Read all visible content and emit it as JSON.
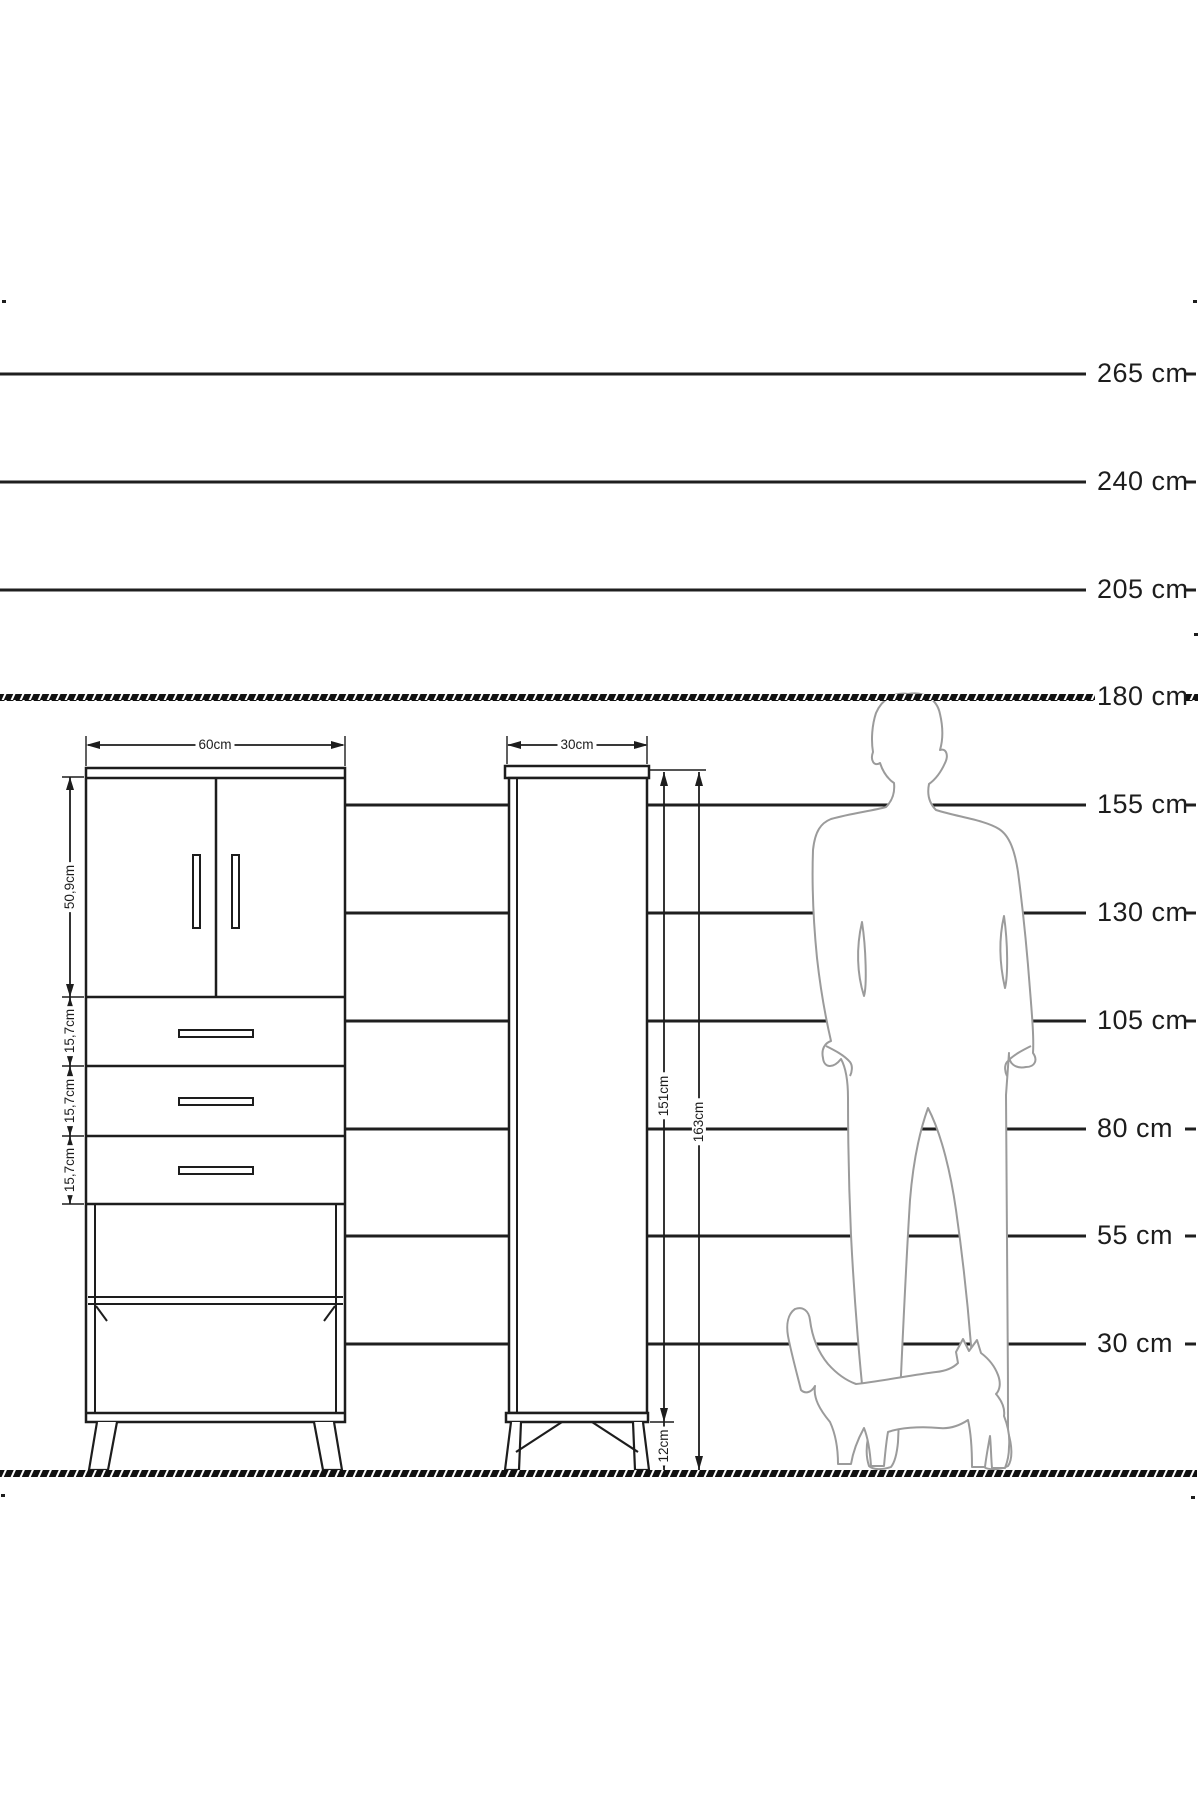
{
  "height_scale": {
    "labels": [
      {
        "text": "265 cm"
      },
      {
        "text": "240 cm"
      },
      {
        "text": "205 cm"
      },
      {
        "text": "180 cm"
      },
      {
        "text": "155 cm"
      },
      {
        "text": "130 cm"
      },
      {
        "text": "105 cm"
      },
      {
        "text": "80 cm"
      },
      {
        "text": "55 cm"
      },
      {
        "text": "30 cm"
      }
    ]
  },
  "left_cabinet": {
    "width_label": "60cm",
    "door_height_label": "50,9cm",
    "drawer_labels": [
      "15,7cm",
      "15,7cm",
      "15,7cm"
    ]
  },
  "right_cabinet": {
    "width_label": "30cm",
    "body_height_label": "151cm",
    "total_height_label": "163cm",
    "leg_height_label": "12cm"
  },
  "colors": {
    "ink": "#1d1d1d",
    "figure_outline": "#9b9b9b",
    "background": "#ffffff"
  }
}
